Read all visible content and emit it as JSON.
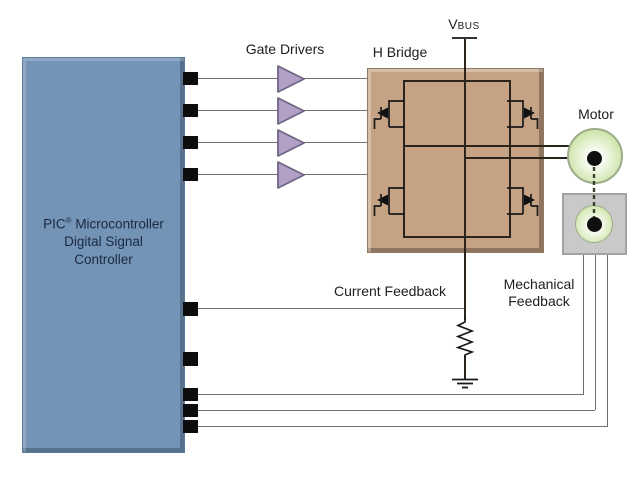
{
  "labels": {
    "gate_drivers": "Gate Drivers",
    "h_bridge": "H Bridge",
    "motor": "Motor",
    "current_feedback": "Current Feedback",
    "mechanical_feedback_line1": "Mechanical",
    "mechanical_feedback_line2": "Feedback",
    "vbus_main": "V",
    "vbus_sub": "BUS"
  },
  "pic": {
    "line1_name": "PIC",
    "line1_reg": "®",
    "line1_rest": " Microcontroller",
    "line2": "Digital Signal",
    "line3": "Controller"
  },
  "colors": {
    "pic_fill": "#7394b7",
    "pic_text": "#1b2940",
    "hbridge_fill": "#c6a285",
    "driver_triangle_fill": "#b2a1c5",
    "motor_green": "#bdd99a",
    "encoder_gray": "#c9c9c9",
    "wire_gray": "#6f6f6f",
    "circuit_dark": "#2b241c"
  }
}
